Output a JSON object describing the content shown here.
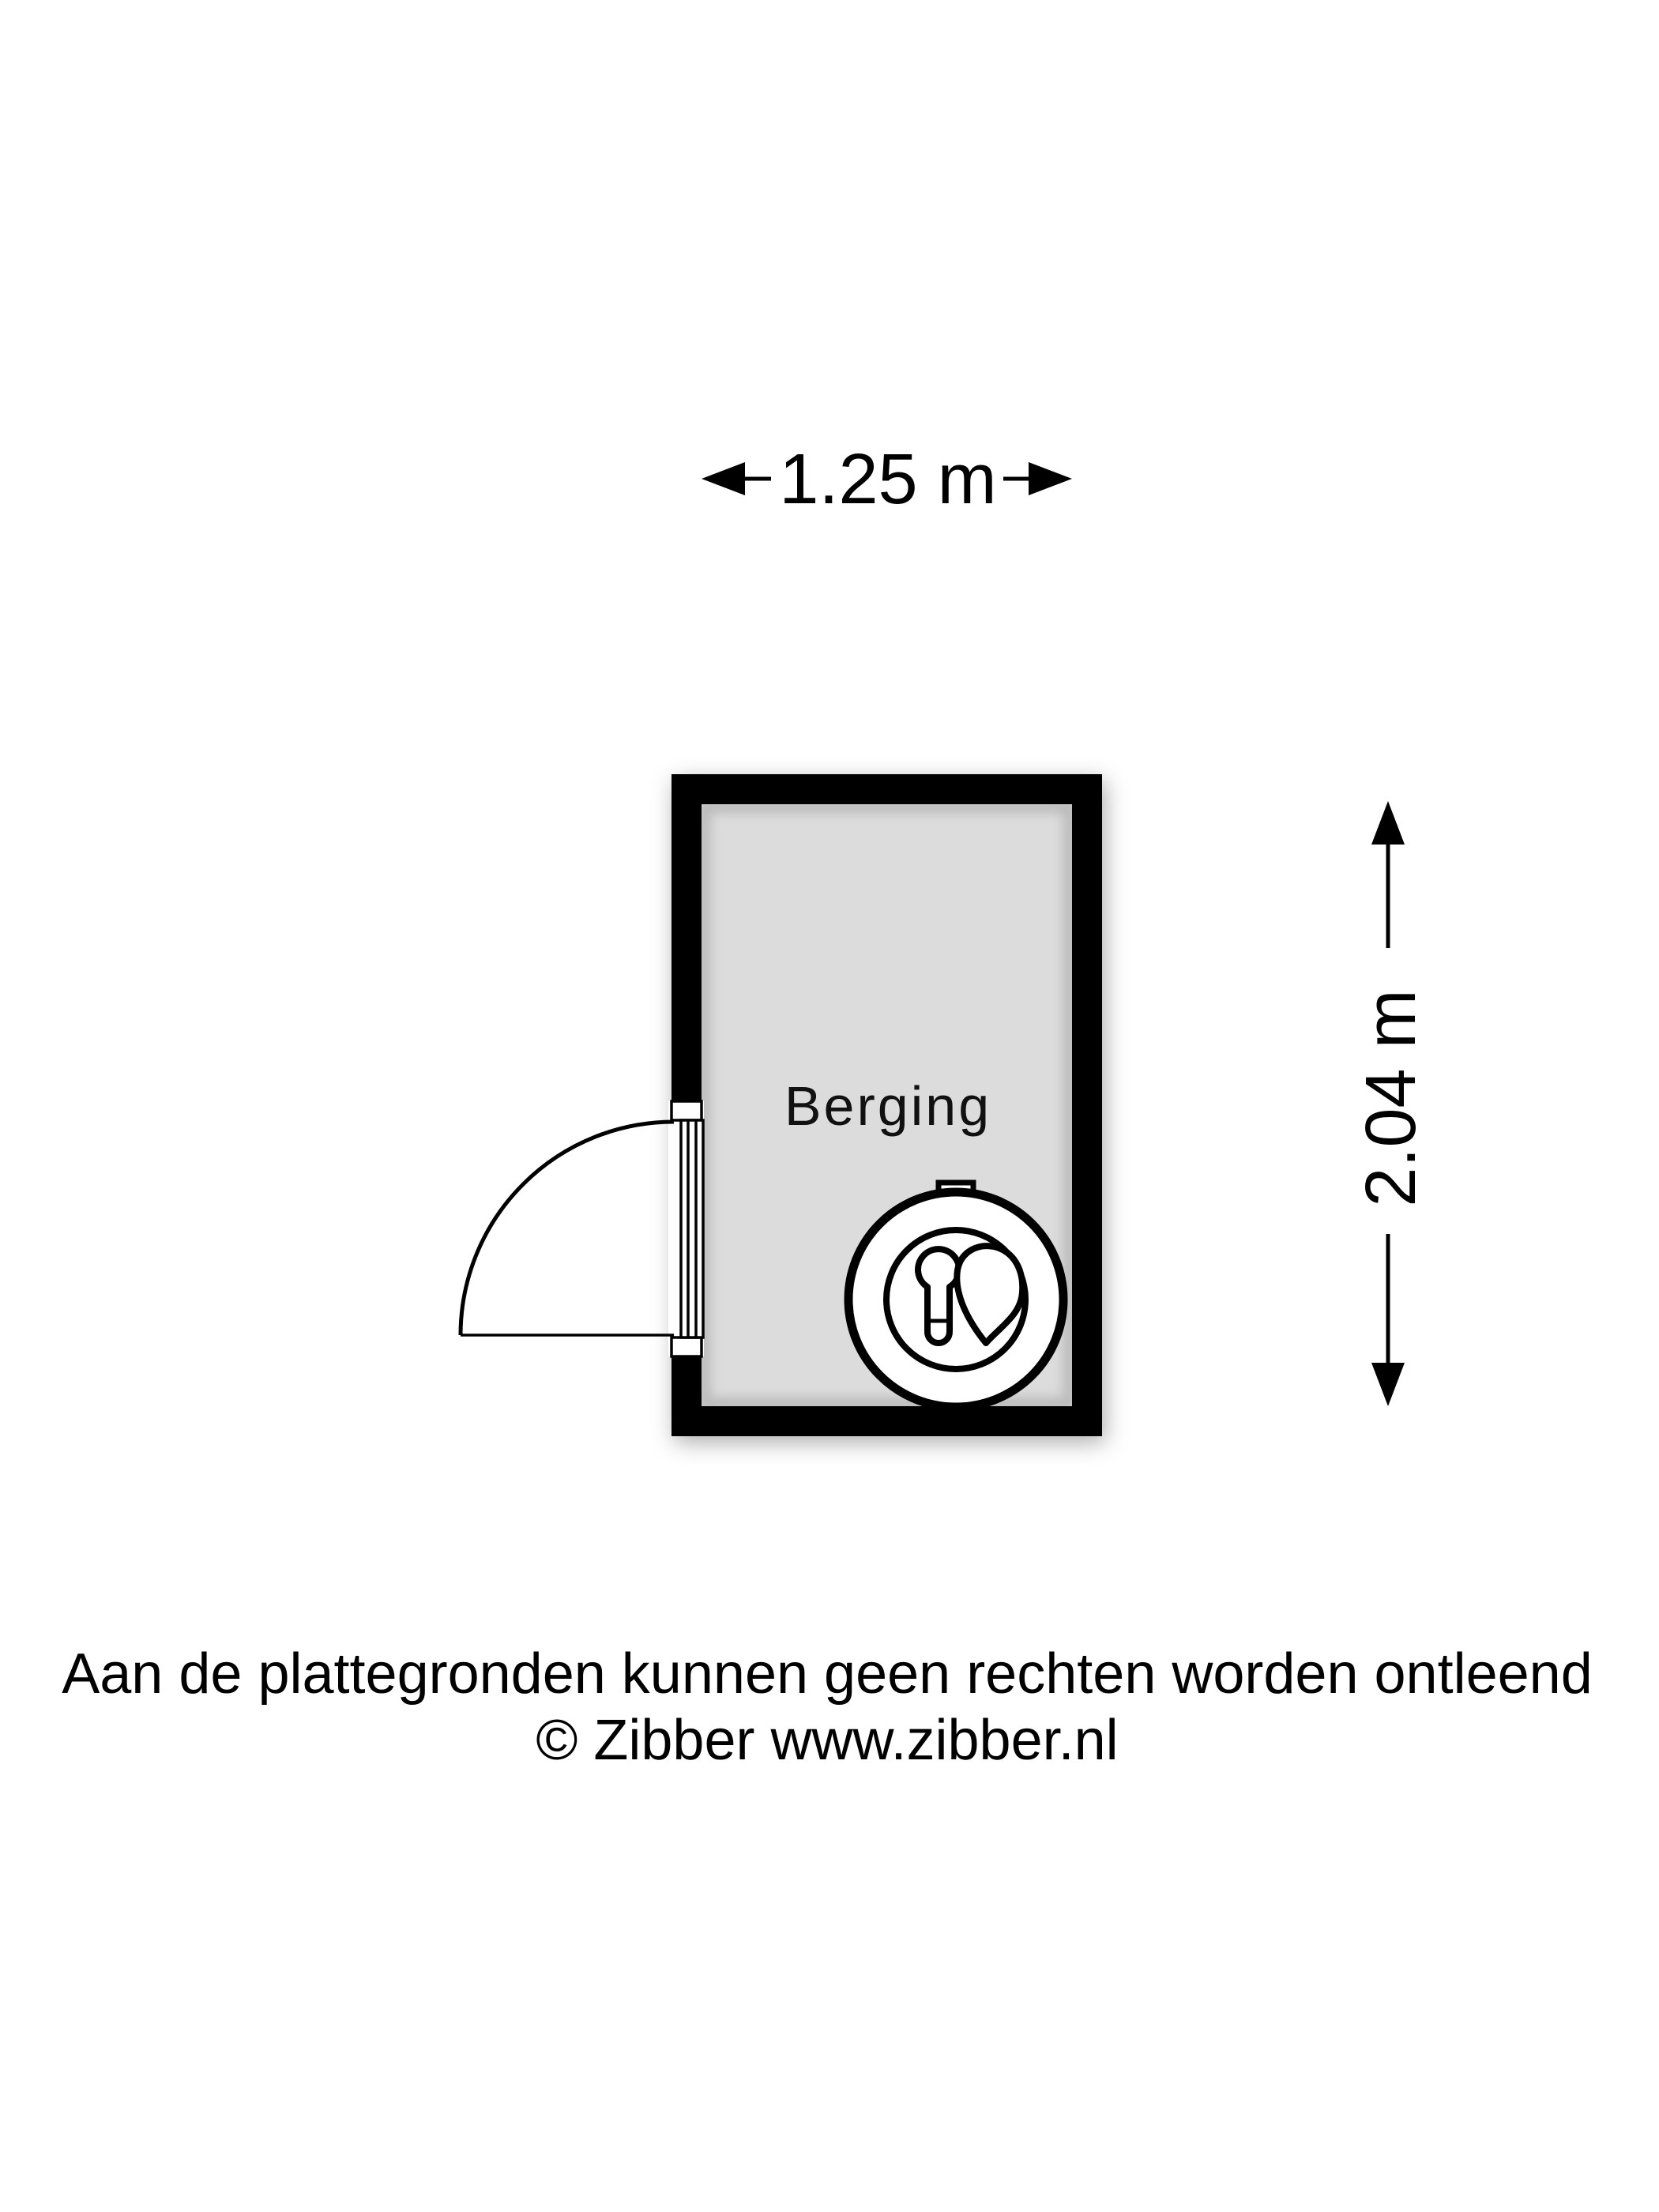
{
  "floorplan": {
    "room": {
      "label": "Berging"
    },
    "dimensions": {
      "width_label": "1.25 m",
      "height_label": "2.04 m"
    },
    "door": {
      "type": "single-swing-door",
      "wall": "left"
    },
    "fixtures": [
      {
        "name": "boiler"
      }
    ],
    "disclaimer": {
      "line1": "Aan de plattegronden kunnen geen rechten worden ontleend",
      "line2": "© Zibber www.zibber.nl"
    },
    "colors": {
      "wall": "#000000",
      "floor": "#dcdcdc",
      "background": "#ffffff",
      "text": "#000000"
    }
  }
}
